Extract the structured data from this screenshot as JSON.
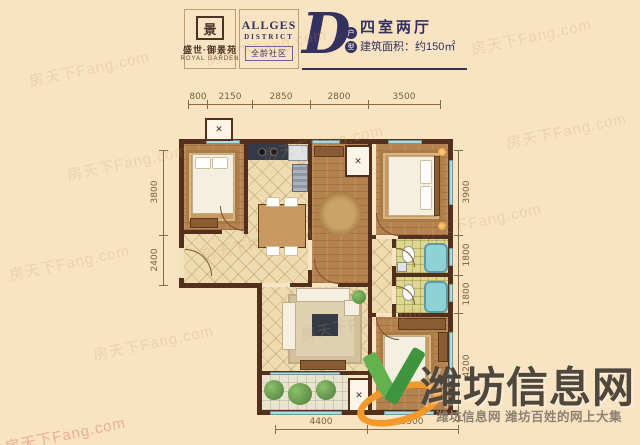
{
  "header": {
    "logo": {
      "seal_char": "景",
      "name": "盛世·御景苑",
      "sub": "ROYAL GARDEN"
    },
    "district": {
      "word1": "ALLGES",
      "word2": "DISTRICT",
      "badge": "全龄社区"
    },
    "unit": {
      "letter": "D",
      "tag_chars": [
        "户",
        "型"
      ],
      "type": "四室两厅",
      "area": "建筑面积：约150㎡"
    }
  },
  "dimensions": {
    "top": [
      "800",
      "2150",
      "2850",
      "2800",
      "3500"
    ],
    "left": [
      "3800",
      "2400"
    ],
    "right": [
      "3900",
      "1800",
      "1800",
      "4200"
    ],
    "bottom": [
      "4400",
      "3500"
    ]
  },
  "watermarks": {
    "diagonal": "房天下Fang.com",
    "brand": "潍坊信息网",
    "tagline": "潍坊信息网 潍坊百姓的网上大集"
  },
  "colors": {
    "background": "#f8e3c2",
    "accent_navy": "#35315e",
    "wall_brown": "#52301c",
    "window_cyan": "#aed9de",
    "brand_orange": "#f2992c",
    "brand_green": "#4ea647"
  }
}
